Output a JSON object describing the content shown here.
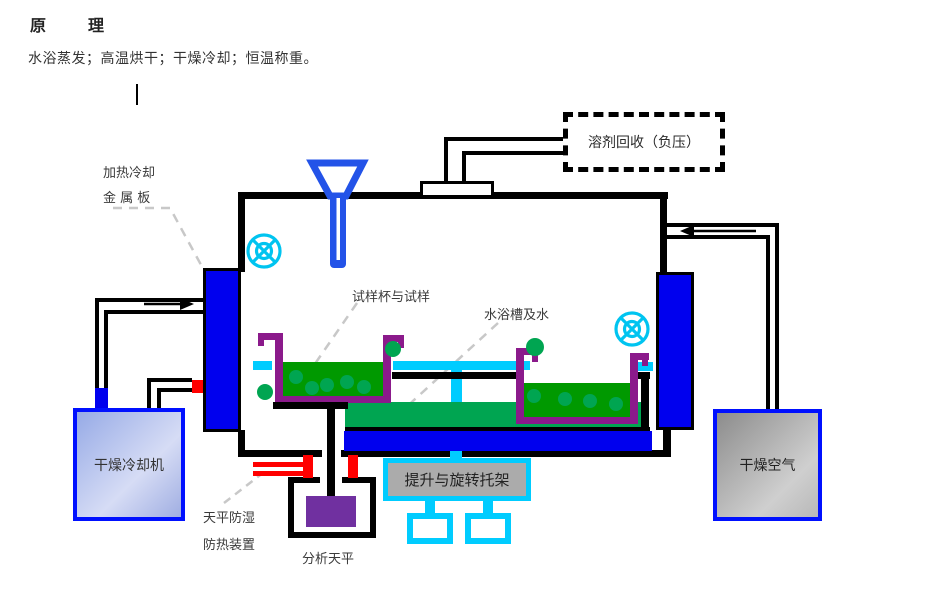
{
  "header": {
    "title": "原　理",
    "subtitle": "水浴蒸发；高温烘干；干燥冷却；恒温称重。"
  },
  "diagram": {
    "solvent_recovery": "溶剂回收（负压）",
    "metal_plate_line1": "加热冷却",
    "metal_plate_line2": "金 属 板",
    "sample_cup_label": "试样杯与试样",
    "water_bath_label": "水浴槽及水",
    "dry_cooler_label": "干燥冷却机",
    "dry_air_label": "干燥空气",
    "lift_rotate_label": "提升与旋转托架",
    "shield_line1": "天平防湿",
    "shield_line2": "防热装置",
    "balance_label": "分析天平"
  },
  "colors": {
    "plate_blue": "#0000EE",
    "water_cyan": "#00CCFF",
    "cup_purple": "#8B1A8B",
    "sample_green": "#009900",
    "platform_green": "#00A551",
    "balance_purple": "#7030A0",
    "pipe_red": "#FF0000",
    "funnel_blue": "#2353E8",
    "fan_cyan": "#00C4F0",
    "leader_gray": "#C8C8C8",
    "box_border_blue": "#0010FF"
  }
}
